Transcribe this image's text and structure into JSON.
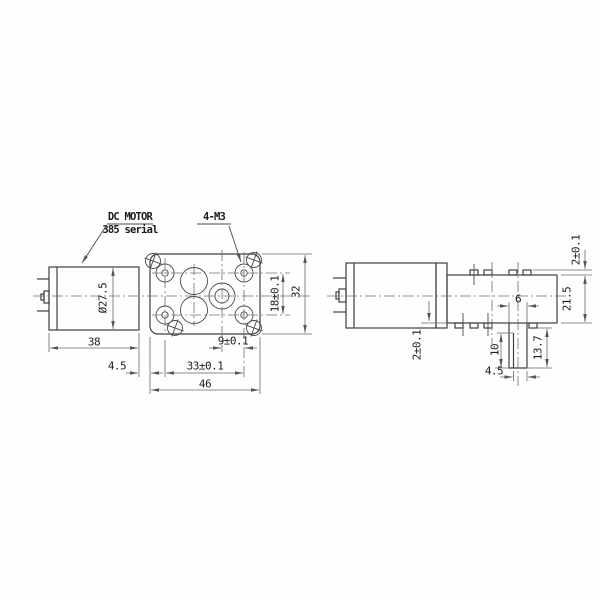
{
  "drawing_title": "DC gear motor engineering drawing (front view and side view)",
  "colors": {
    "background": "#fefefe",
    "outline": "#3f3f3f",
    "dimension": "#6a6a6a",
    "text": "#1b1b1b"
  },
  "left_view": {
    "labels": {
      "motor1": "DC MOTOR",
      "motor2": "385 serial",
      "holes": "4-M3"
    },
    "dims": {
      "motor_diameter": "Ø27.5",
      "motor_length": "38",
      "plate_offset": "4.5",
      "hole_spacing_h": "33±0.1",
      "shaft_to_hole": "9±0.1",
      "plate_width": "46",
      "hole_spacing_v": "18±0.1",
      "plate_height": "32"
    }
  },
  "right_view": {
    "dims": {
      "tab_protrusion": "2±0.1",
      "gearbox_height": "21.5",
      "shaft_diameter": "6",
      "motor_offset": "2±0.1",
      "shaft_flat_length": "10",
      "shaft_length": "13.7",
      "shaft_flat_width": "4.5"
    }
  }
}
